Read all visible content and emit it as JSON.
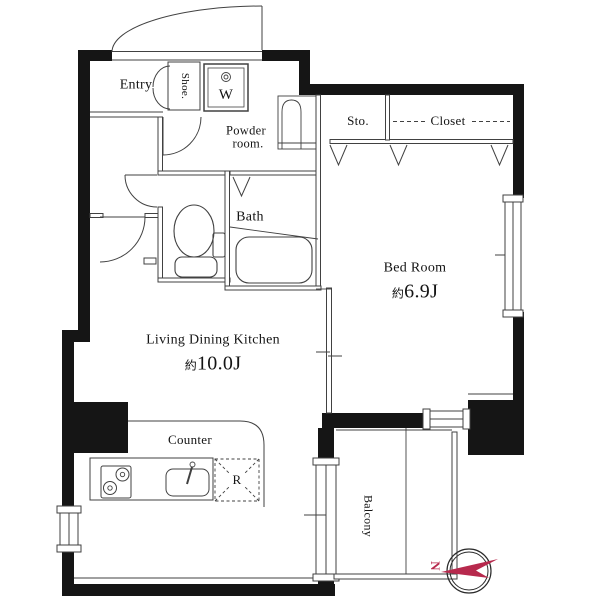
{
  "rooms": {
    "entry": "Entry",
    "shoe": "Shoe.",
    "washer": "W",
    "powder_line1": "Powder",
    "powder_line2": "room.",
    "storage": "Sto.",
    "closet": "Closet",
    "bath": "Bath",
    "bedroom": "Bed Room",
    "ldk": "Living Dining Kitchen",
    "counter": "Counter",
    "refrigerator": "R",
    "balcony": "Balcony"
  },
  "sizes": {
    "bedroom_prefix": "約",
    "bedroom_value": "6.9J",
    "ldk_prefix": "約",
    "ldk_value": "10.0J"
  },
  "compass": {
    "north_label": "N",
    "needle_color": "#b7294d"
  },
  "colors": {
    "wall": "#151515",
    "line": "#414141",
    "background": "#ffffff"
  }
}
